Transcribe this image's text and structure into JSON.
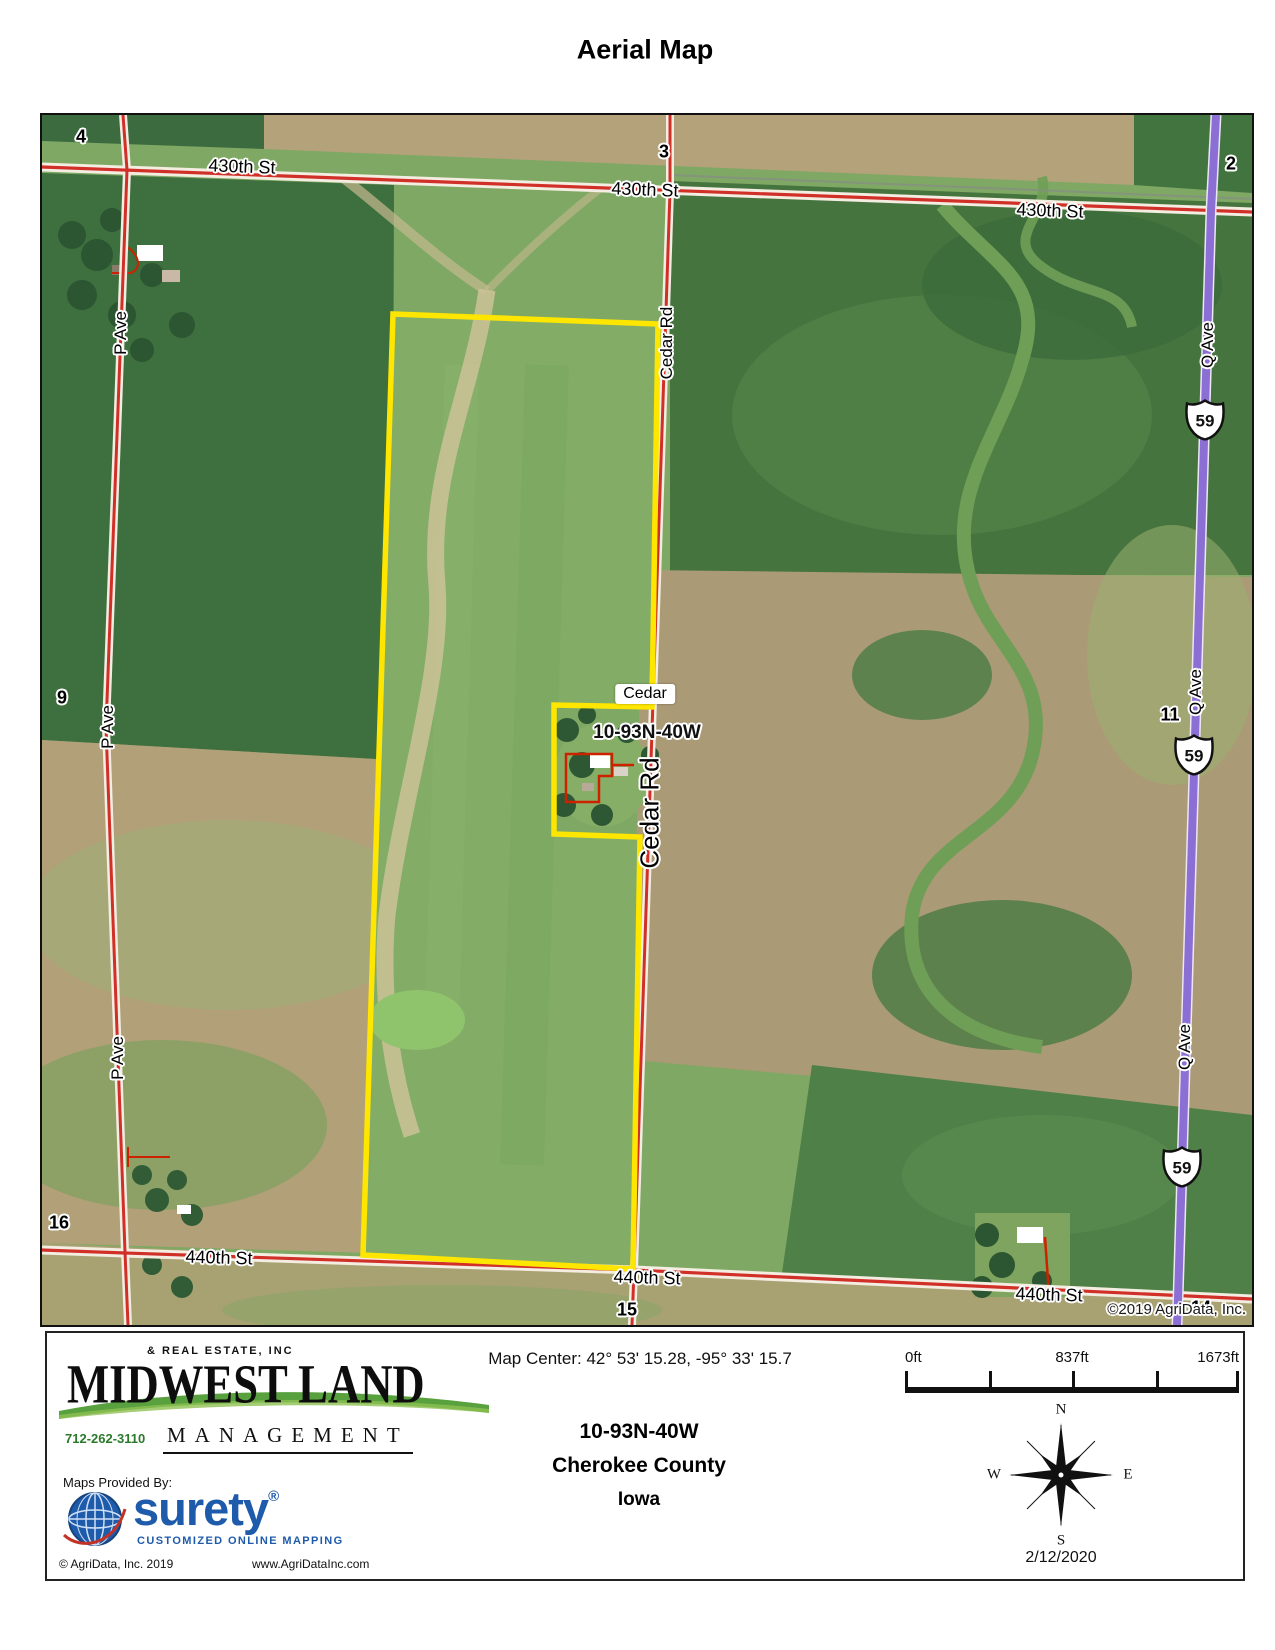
{
  "page_title": "Aerial Map",
  "map": {
    "copyright_overlay": "©2019 AgriData, Inc.",
    "road_labels": {
      "st430": [
        "430th St",
        "430th St",
        "430th St"
      ],
      "st440": [
        "440th St",
        "440th St",
        "440th St"
      ],
      "p_ave": [
        "P Ave",
        "P Ave",
        "P Ave"
      ],
      "q_ave": [
        "Q Ave",
        "Q Ave",
        "Q Ave"
      ],
      "cedar_rd": [
        "Cedar Rd",
        "Cedar Rd"
      ],
      "cedar_box": "Cedar",
      "township_overlay": "10-93N-40W"
    },
    "highway_shields": [
      "59",
      "59",
      "59"
    ],
    "section_numbers": [
      "4",
      "3",
      "2",
      "9",
      "11",
      "16",
      "15",
      "14"
    ],
    "colors": {
      "parcel_outline": "#ffe600",
      "road_red": "#d03028",
      "highway_purple": "#8b6fd4",
      "farmstead_outline": "#cc2200"
    }
  },
  "footer": {
    "logo": {
      "tagline_top": "& REAL ESTATE, INC",
      "name": "MIDWEST LAND",
      "management": "MANAGEMENT",
      "phone": "712-262-3110"
    },
    "map_center": "Map Center: 42° 53' 15.28,  -95° 33' 15.7",
    "scale": {
      "labels": [
        "0ft",
        "837ft",
        "1673ft"
      ]
    },
    "location": {
      "township": "10-93N-40W",
      "county": "Cherokee County",
      "state": "Iowa"
    },
    "compass": {
      "n": "N",
      "s": "S",
      "e": "E",
      "w": "W"
    },
    "date": "2/12/2020",
    "provider": {
      "label": "Maps Provided By:",
      "brand": "surety",
      "reg": "®",
      "sub": "CUSTOMIZED ONLINE MAPPING",
      "copyright": "© AgriData, Inc. 2019",
      "website": "www.AgriDataInc.com"
    }
  }
}
